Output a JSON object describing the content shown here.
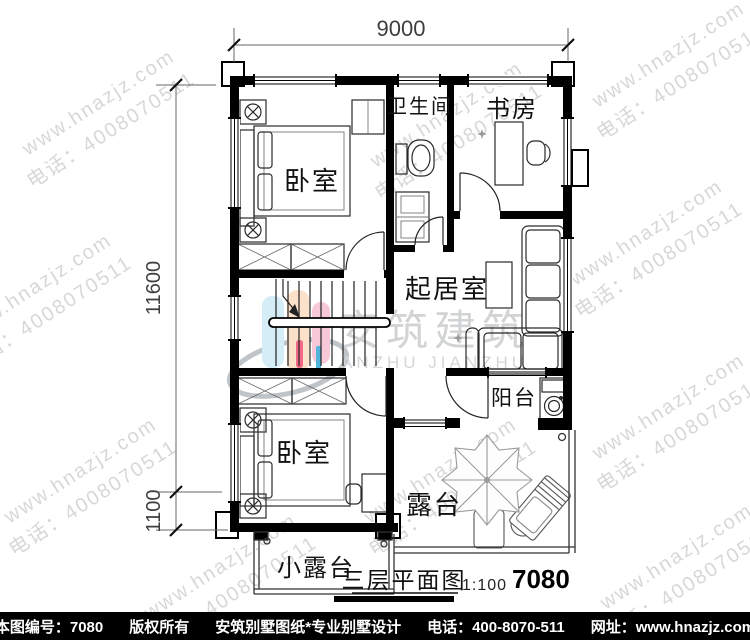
{
  "watermark": {
    "line1": "www.hnazjz.com",
    "line2": "电话：4008070511"
  },
  "logo": {
    "text": "安筑建筑",
    "subtext": "ANZHU JIANZHU"
  },
  "colors": {
    "logo_cyan": "#cdeaf6",
    "logo_peach": "#fbdcc0",
    "logo_pink": "#f6bfd1",
    "logo_red": "#f04f73",
    "logo_blue": "#34a8d8",
    "swoosh": "#b4bac0",
    "watermark_gray": "#b7b7b7",
    "footer_bg": "#000000",
    "line_black": "#111111"
  },
  "dimensions": {
    "top": "9000",
    "left_main": "11600",
    "left_small": "1100"
  },
  "rooms": {
    "bedroom_top": "卧室",
    "bathroom": "卫生间",
    "study": "书房",
    "living": "起居室",
    "bedroom_bottom": "卧室",
    "balcony": "阳台",
    "terrace": "露台",
    "small_terrace": "小露台"
  },
  "title": {
    "name": "三层平面图",
    "scale": "1:100",
    "number": "7080"
  },
  "footer": {
    "plan_no": "本图编号：7080",
    "copyright": "版权所有",
    "brand": "安筑别墅图纸*专业别墅设计",
    "phone": "电话：400-8070-511",
    "website": "网址：www.hnazjz.com"
  }
}
